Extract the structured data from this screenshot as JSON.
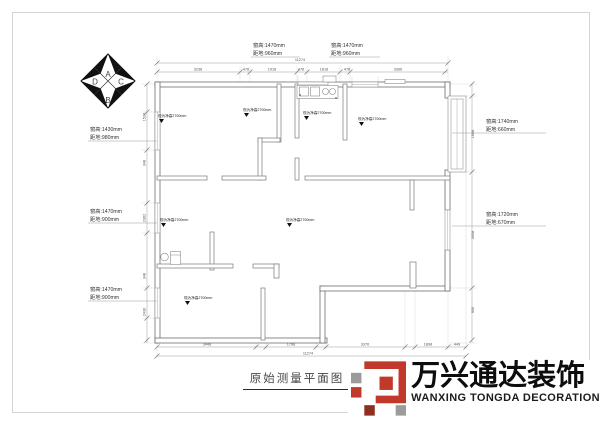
{
  "sheet": {
    "title": "原始测量平面图"
  },
  "compass": {
    "top": "A",
    "right": "C",
    "bottom": "B",
    "left": "D"
  },
  "window_labels": {
    "top1": [
      "窗高:1470mm",
      "距地:960mm"
    ],
    "top2": [
      "窗高:1470mm",
      "距地:960mm"
    ],
    "left1": [
      "窗高:1430mm",
      "距地:980mm"
    ],
    "left2": [
      "窗高:1470mm",
      "距地:900mm"
    ],
    "left3": [
      "窗高:1470mm",
      "距地:900mm"
    ],
    "right1": [
      "窗高:1740mm",
      "距地:660mm"
    ],
    "right2": [
      "窗高:1720mm",
      "距地:670mm"
    ]
  },
  "room_labels": [
    "现为净高2700mm",
    "现为净高2700mm",
    "现为净高2700mm",
    "现为净高2700mm",
    "现为净高2700mm",
    "现为净高2700mm",
    "现为净高2700mm"
  ],
  "dims": {
    "top_total": "11274",
    "top": [
      "3238",
      "478",
      "1918",
      "478",
      "1818",
      "478",
      "3366"
    ],
    "bottom": [
      "3448",
      "1768",
      "3376",
      "1898",
      "449"
    ],
    "bottom_total": "11274",
    "left": [
      "1530",
      "348",
      "2362",
      "348",
      "2430"
    ],
    "right": [
      "1668",
      "3008",
      "900"
    ]
  },
  "logo": {
    "cn": "万兴通达装饰",
    "en": "WANXING TONGDA DECORATION",
    "colors": {
      "red": "#c0392b",
      "dark_red": "#8e2f22",
      "gray": "#9b9b9b"
    }
  }
}
